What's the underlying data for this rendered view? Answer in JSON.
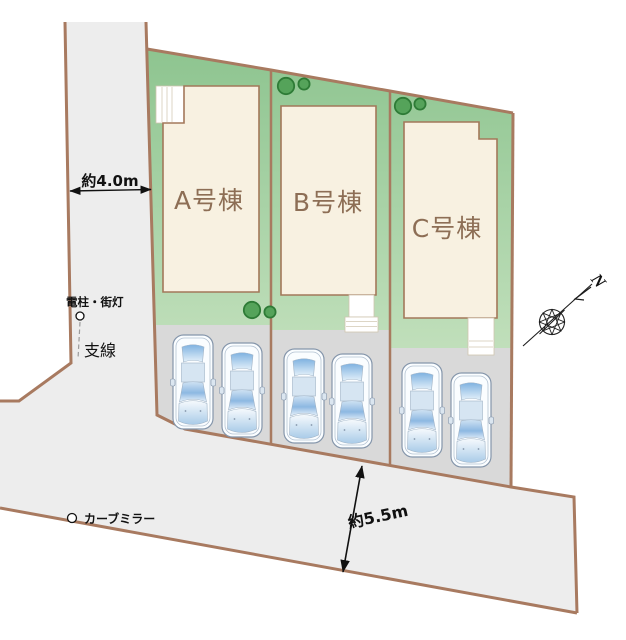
{
  "plan": {
    "lots": [
      {
        "id": "A",
        "label": "A号棟",
        "parking_spaces": 2
      },
      {
        "id": "B",
        "label": "B号棟",
        "parking_spaces": 2
      },
      {
        "id": "C",
        "label": "C号棟",
        "parking_spaces": 2
      }
    ],
    "annotations": {
      "front_road_width": "約4.0m",
      "side_road_width": "約5.5m",
      "utility_pole_label": "電柱・街灯",
      "guy_wire_label": "支線",
      "curve_mirror_label": "カーブミラー",
      "compass_north_label": "N"
    },
    "colors": {
      "boundary": "#a87a60",
      "road-fill": "#ededed",
      "parking-fill": "#d9d9d9",
      "lot-green-top": "#8dc48f",
      "lot-green-bottom": "#d7ebce",
      "building-fill": "#f8f1e1",
      "building-stroke": "#a3785a",
      "tree-fill": "#55a35a",
      "tree-stroke": "#2e7b36",
      "label-brown": "#8d6e55",
      "annotation-black": "#111111"
    }
  }
}
